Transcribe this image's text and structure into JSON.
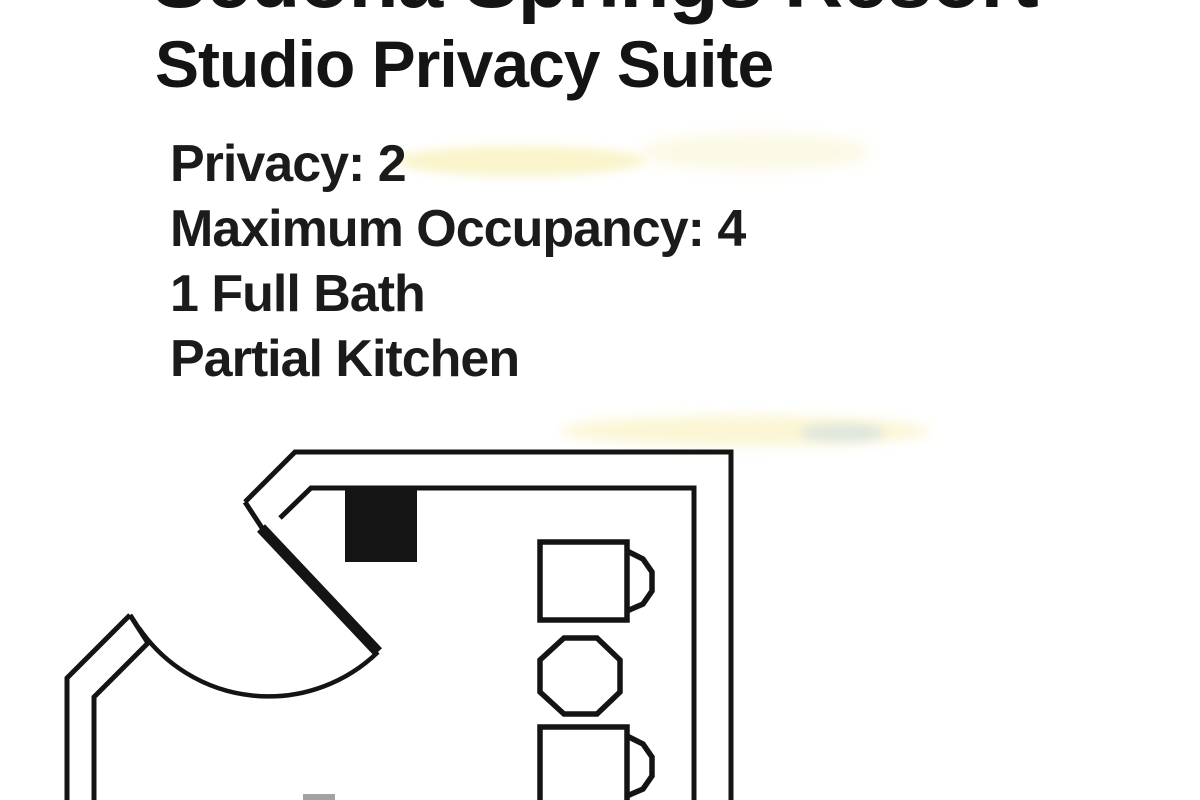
{
  "page": {
    "background_color": "#ffffff",
    "text_color": "#161616",
    "title": {
      "line1": "Sedona Springs Resort",
      "line2": "Studio Privacy Suite"
    },
    "details": [
      "Privacy: 2",
      "Maximum Occupancy: 4",
      "1 Full Bath",
      "Partial Kitchen"
    ]
  },
  "floor_plan": {
    "kind": "studio suite floor plan drawing",
    "line_color": "#141414",
    "elements": [
      "double-line-walls",
      "entry-door-leaf",
      "door-swing-arc",
      "solid-wall-fixture",
      "dining-chair",
      "dining-table",
      "dining-chair"
    ]
  },
  "artifacts": {
    "highlight_color_yellow": "#f6eba0",
    "highlight_color_blue": "#aac8eb"
  }
}
